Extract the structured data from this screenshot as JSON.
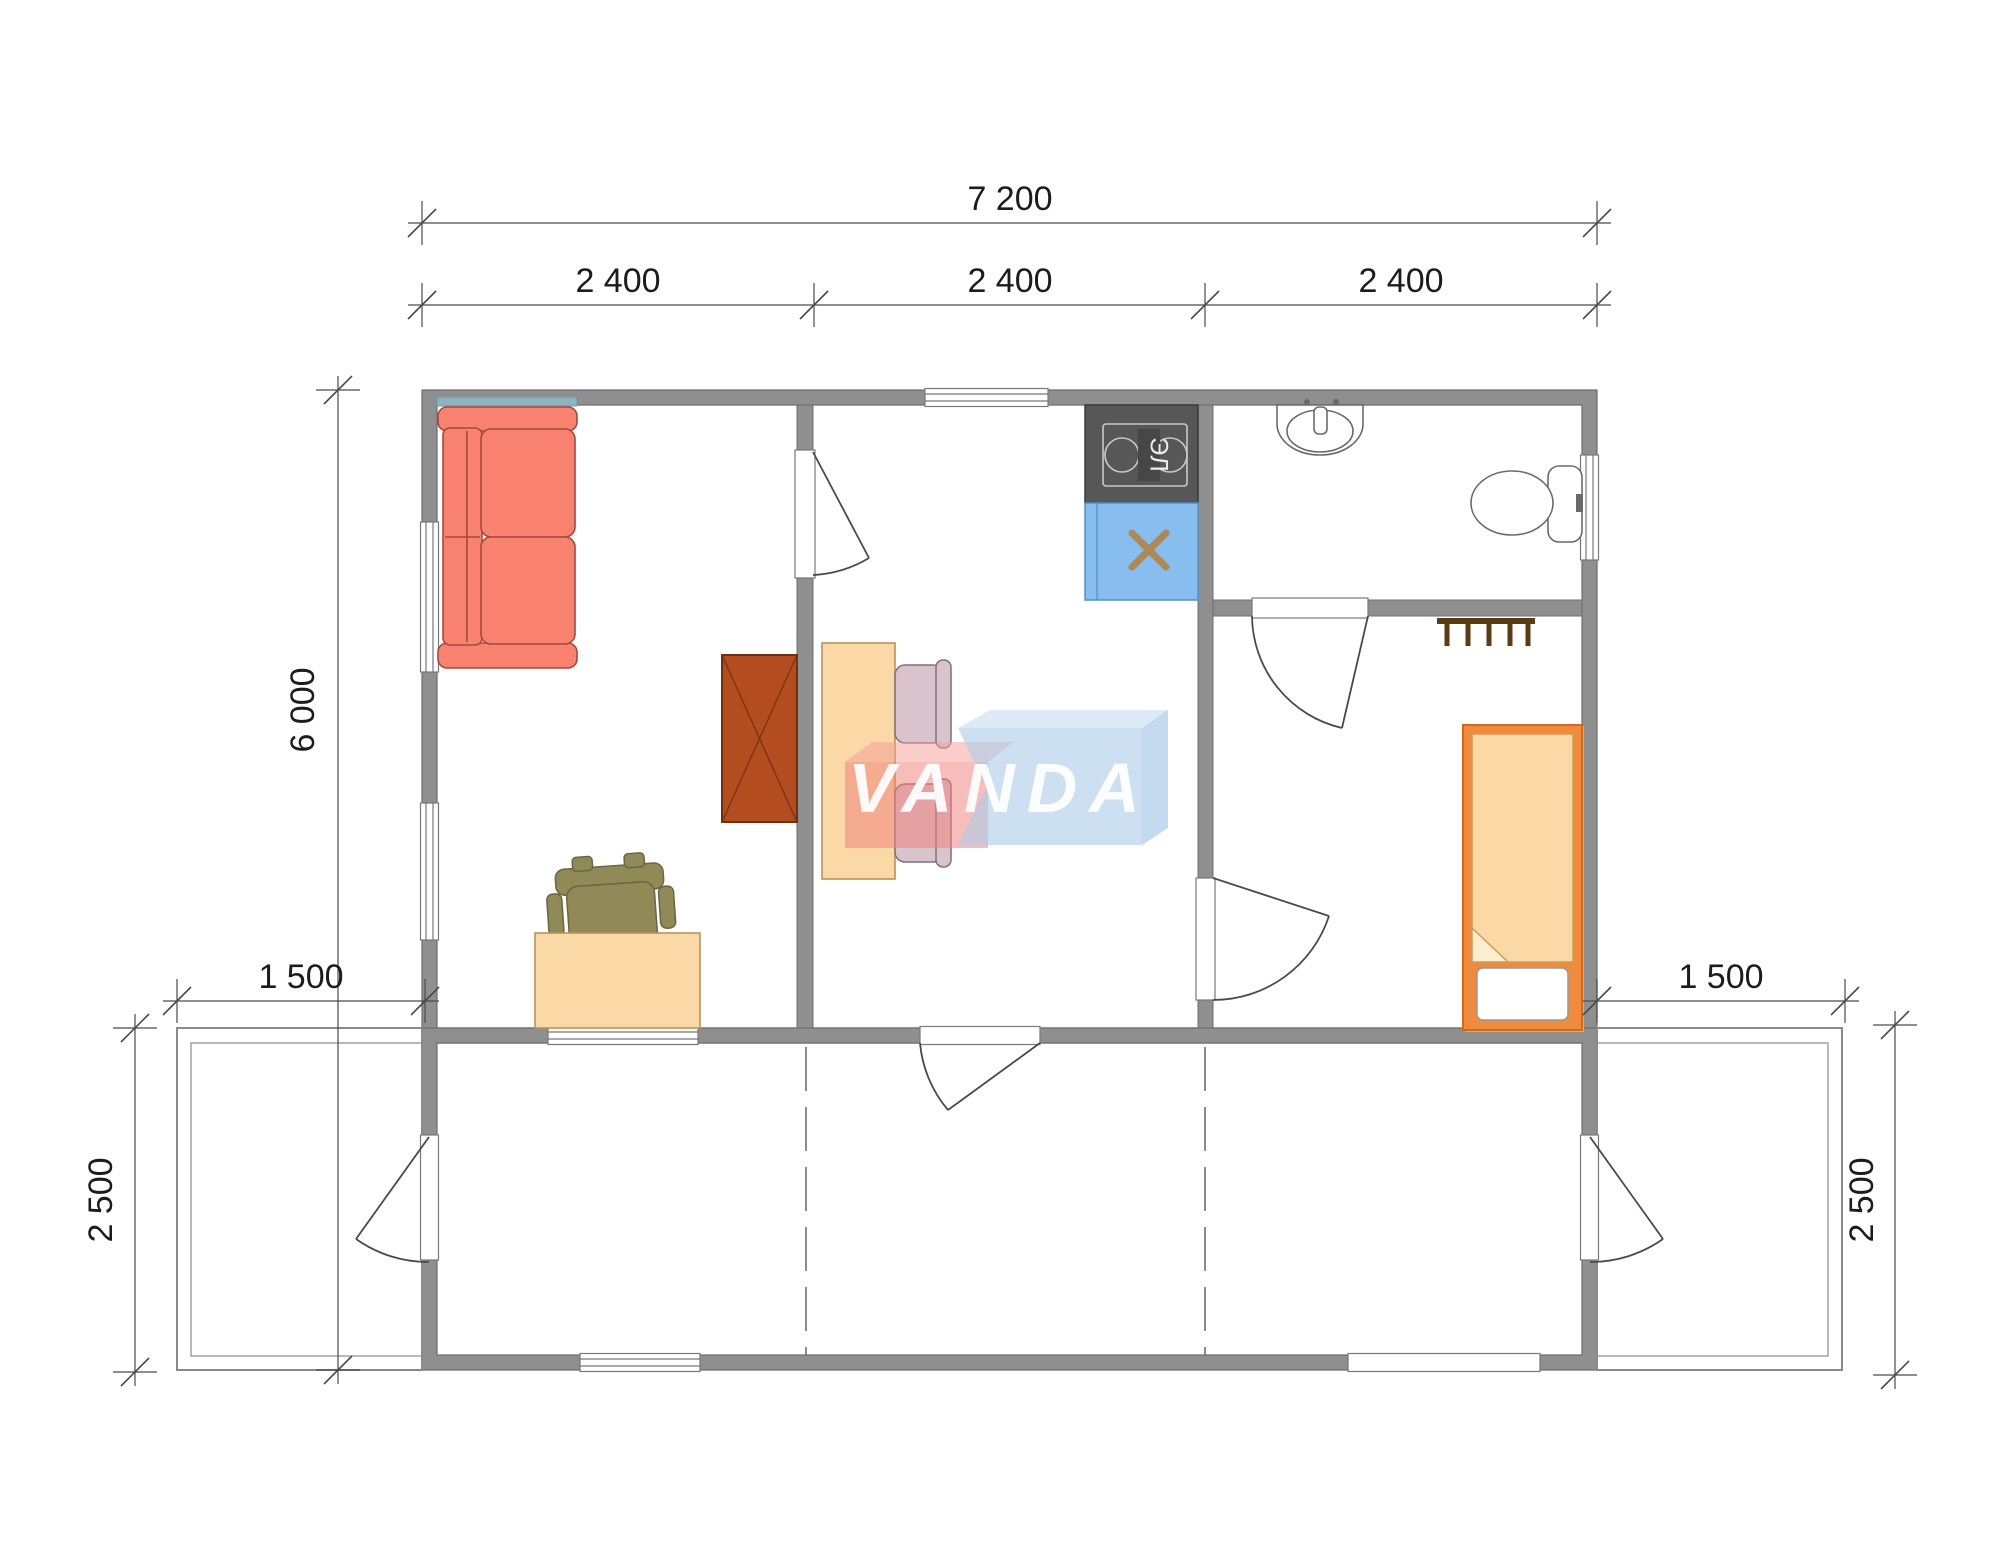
{
  "watermark": {
    "text": "VANDA"
  },
  "kitchen": {
    "stove_label": "ЭЛ"
  },
  "dimensions": {
    "total_width": "7 200",
    "modules": [
      "2 400",
      "2 400",
      "2 400"
    ],
    "side_height": "6 000",
    "terrace_left_width": "1 500",
    "terrace_right_width": "1 500",
    "terrace_left_depth": "2 500",
    "terrace_right_depth": "2 500"
  },
  "colors": {
    "wall": "#8f8f8f",
    "wall_edge": "#6e6e6e",
    "sofa": "#f8826f",
    "sofa_edge": "#a34a3e",
    "teal_strip": "#8fb2c0",
    "wardrobe": "#b34d1f",
    "peach_furniture": "#fbd9a6",
    "office_chair": "#8f8a58",
    "kitchen_counter": "#575757",
    "kitchen_sink": "#87bdef",
    "sink_cross": "#ab8a55",
    "bed_frame": "#f08a3c",
    "bed_shadow": "#9db8d2",
    "towel_rack": "#5a3c14",
    "dining_chair": "#d9c4ce",
    "watermark_red": "rgba(240,128,122,0.52)",
    "watermark_red_top": "rgba(246,158,154,0.52)",
    "watermark_blue": "rgba(172,205,233,0.62)",
    "watermark_blue_top": "rgba(198,222,242,0.62)"
  }
}
